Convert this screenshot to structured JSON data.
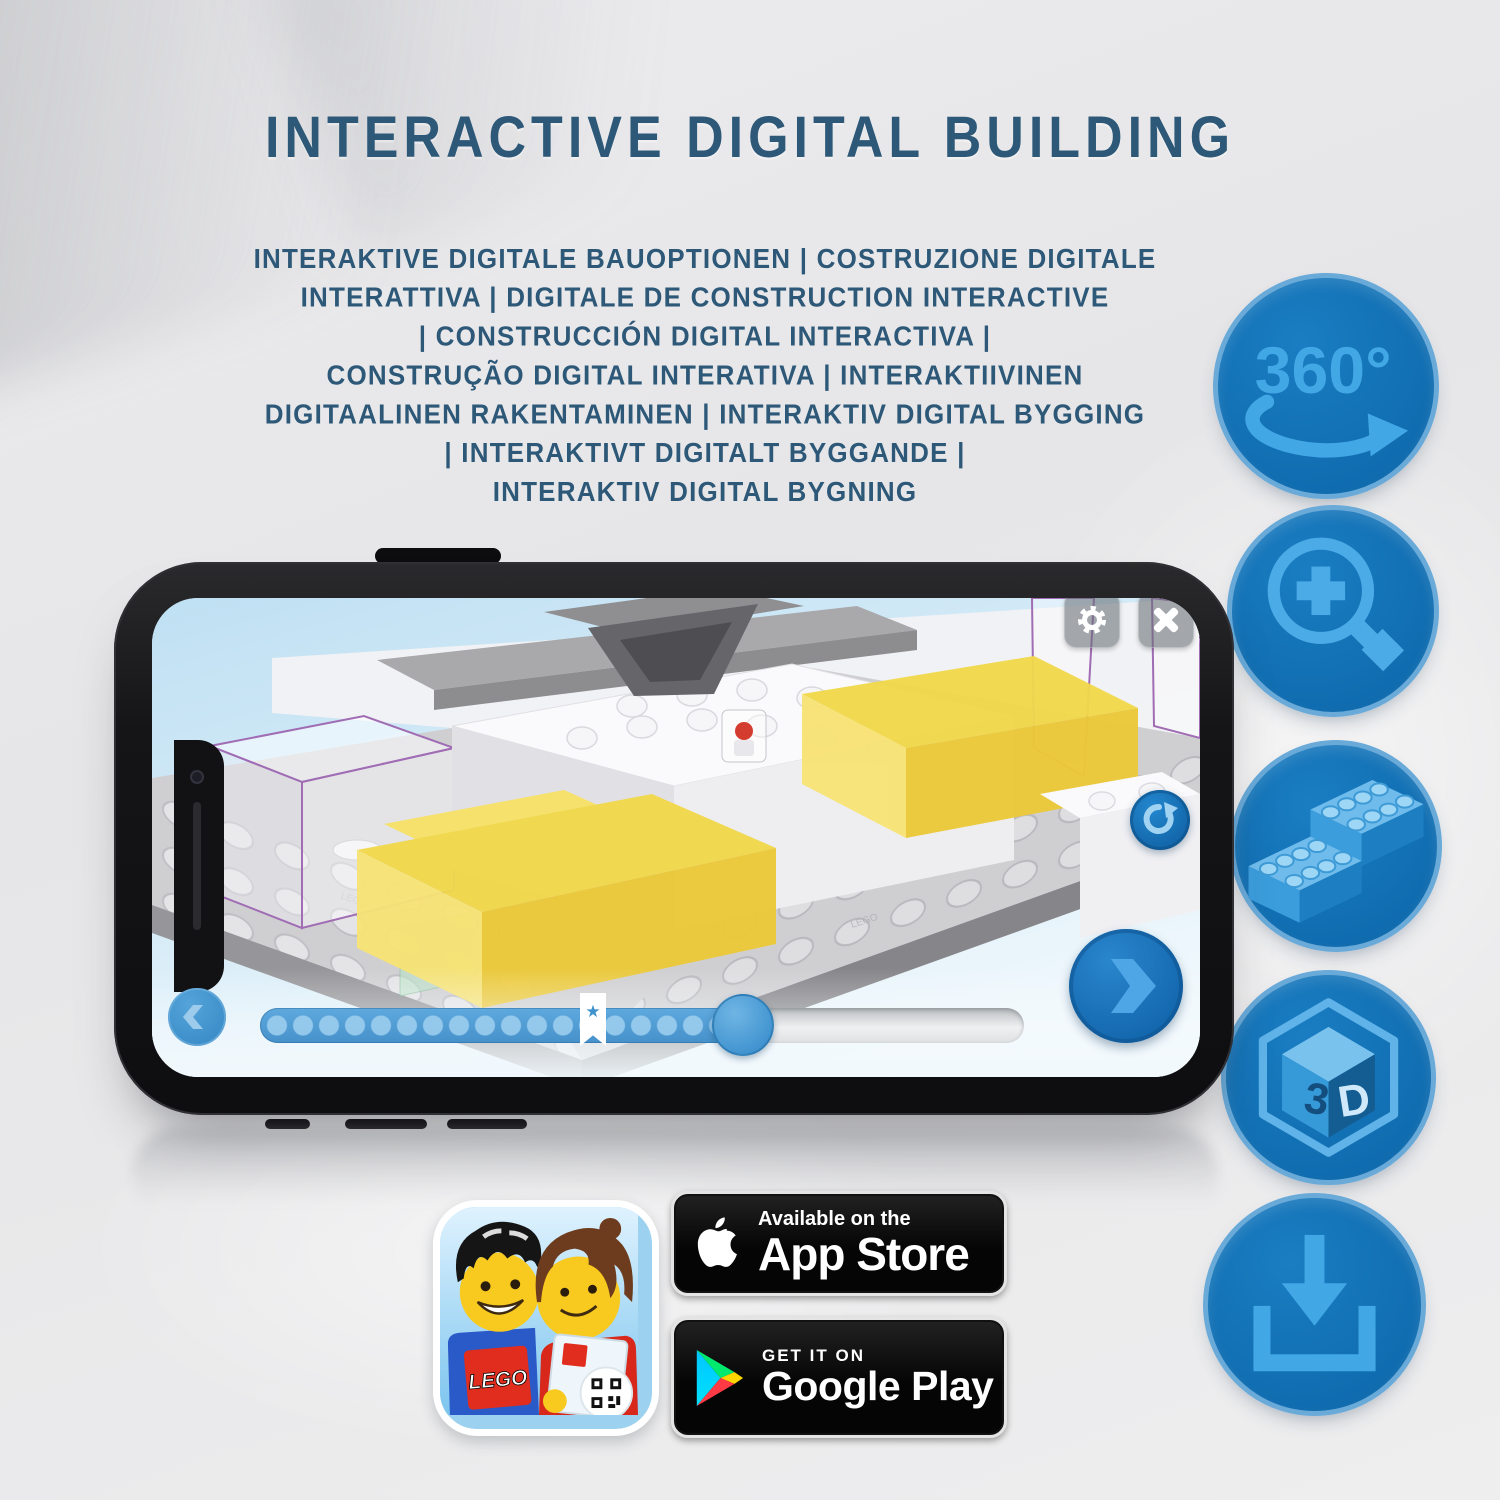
{
  "header": {
    "title": "INTERACTIVE DIGITAL BUILDING"
  },
  "subtitle": {
    "lines": [
      "INTERAKTIVE DIGITALE BAUOPTIONEN | COSTRUZIONE DIGITALE",
      "INTERATTIVA | DIGITALE DE CONSTRUCTION INTERACTIVE",
      "| CONSTRUCCIÓN DIGITAL INTERACTIVA |",
      "CONSTRUÇÃO DIGITAL INTERATIVA | INTERAKTIIVINEN",
      "DIGITAALINEN RAKENTAMINEN | INTERAKTIV DIGITAL BYGGING",
      "| INTERAKTIVT DIGITALT BYGGANDE |",
      "INTERAKTIV DIGITAL BYGNING"
    ]
  },
  "features": {
    "rotate_label": "360°",
    "cube_left": "3",
    "cube_right": "D",
    "items": [
      {
        "name": "rotate-360-icon"
      },
      {
        "name": "zoom-in-icon"
      },
      {
        "name": "lego-bricks-icon"
      },
      {
        "name": "3d-cube-icon"
      },
      {
        "name": "download-icon"
      }
    ]
  },
  "phone": {
    "screen": {
      "stud_emboss": "LEGO"
    }
  },
  "store": {
    "lego_logo": "LEGO",
    "app_store": {
      "line1": "Available on the",
      "line2": "App Store"
    },
    "google_play": {
      "line1": "GET IT ON",
      "line2": "Google Play"
    }
  },
  "colors": {
    "title_blue": "#2d5878",
    "circle_blue": "#1171b6",
    "icon_blue": "#3fa6e4",
    "highlight_yellow": "#f1d84b",
    "slider_blue": "#4d9dd6"
  }
}
